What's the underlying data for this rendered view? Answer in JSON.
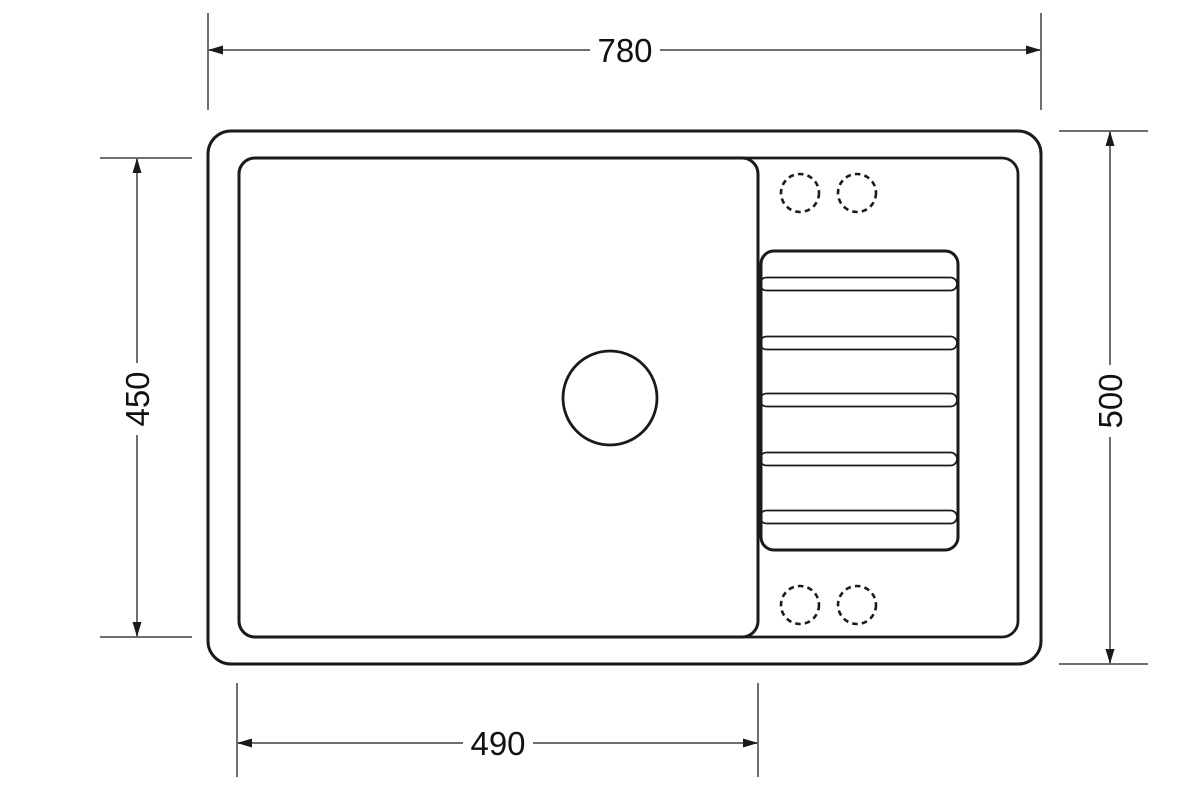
{
  "diagram": {
    "description": "Kitchen sink with drainer, top view technical drawing",
    "labels": {
      "dim_top": "780",
      "dim_left": "450",
      "dim_right": "500",
      "dim_bottom": "490"
    },
    "counts": {
      "drainer_grooves": 5,
      "tap_holes": 4
    },
    "colors": {
      "background": "#ffffff",
      "outline": "#1a1a1a",
      "dimension_line": "#6f6f6f",
      "dimension_text": "#111111"
    }
  }
}
